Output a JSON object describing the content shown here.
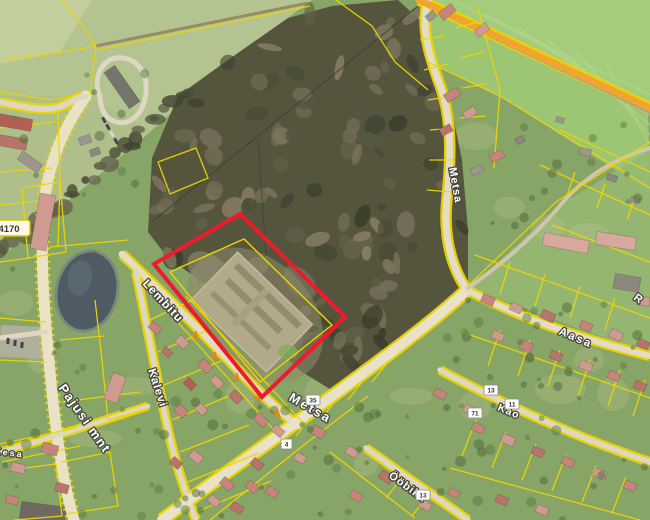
{
  "map": {
    "type": "aerial-orthophoto-cadastral-map",
    "street_labels": [
      {
        "id": "lembitu",
        "text": "Lembitu"
      },
      {
        "id": "kalevi",
        "text": "Kalevi"
      },
      {
        "id": "pajusi-mnt",
        "text": "Pajusi mnt"
      },
      {
        "id": "metsa-north",
        "text": "Metsa"
      },
      {
        "id": "metsa-south",
        "text": "Metsa"
      },
      {
        "id": "aasa",
        "text": "Aasa"
      },
      {
        "id": "kao",
        "text": "Kao"
      },
      {
        "id": "oobiku",
        "text": "Ööbiku"
      },
      {
        "id": "kesa",
        "text": "Kesa"
      },
      {
        "id": "r-partial",
        "text": "R"
      }
    ],
    "road_number_badge": {
      "text": "4170"
    },
    "house_numbers": [
      "35",
      "4",
      "13",
      "11",
      "71",
      "13"
    ],
    "colors": {
      "cadastral_line": "#ecd500",
      "selected_parcel": "#ee1b2d",
      "highlighted_road": "#f2a52e",
      "one_way_arrow": "#e8821e",
      "road_surface": "#e9e1c8",
      "forest": "#55553e",
      "field_light": "#b3c490",
      "field_bright": "#9cc674",
      "residential_green": "#87a566",
      "pond": "#4e5a64"
    }
  }
}
